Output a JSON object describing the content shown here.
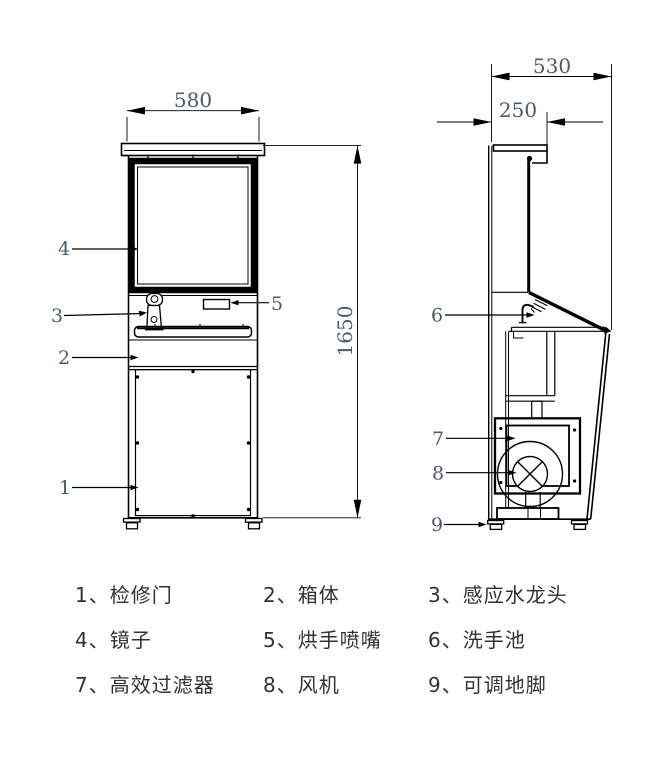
{
  "colors": {
    "background": "#ffffff",
    "line": "#000000",
    "dimension_text": "#4a5a6c",
    "legend_text": "#2f3337"
  },
  "dimensions": {
    "front_width": "580",
    "overall_height": "1650",
    "side_depth": "530",
    "top_depth": "250"
  },
  "callouts": {
    "c1": "1",
    "c2": "2",
    "c3": "3",
    "c4": "4",
    "c5": "5",
    "c6": "6",
    "c7": "7",
    "c8": "8",
    "c9": "9"
  },
  "legend": {
    "rows": [
      [
        "1、检修门",
        "2、箱体",
        "3、感应水龙头"
      ],
      [
        "4、镜子",
        "5、烘手喷嘴",
        "6、洗手池"
      ],
      [
        "7、高效过滤器",
        "8、风机",
        "9、可调地脚"
      ]
    ]
  }
}
